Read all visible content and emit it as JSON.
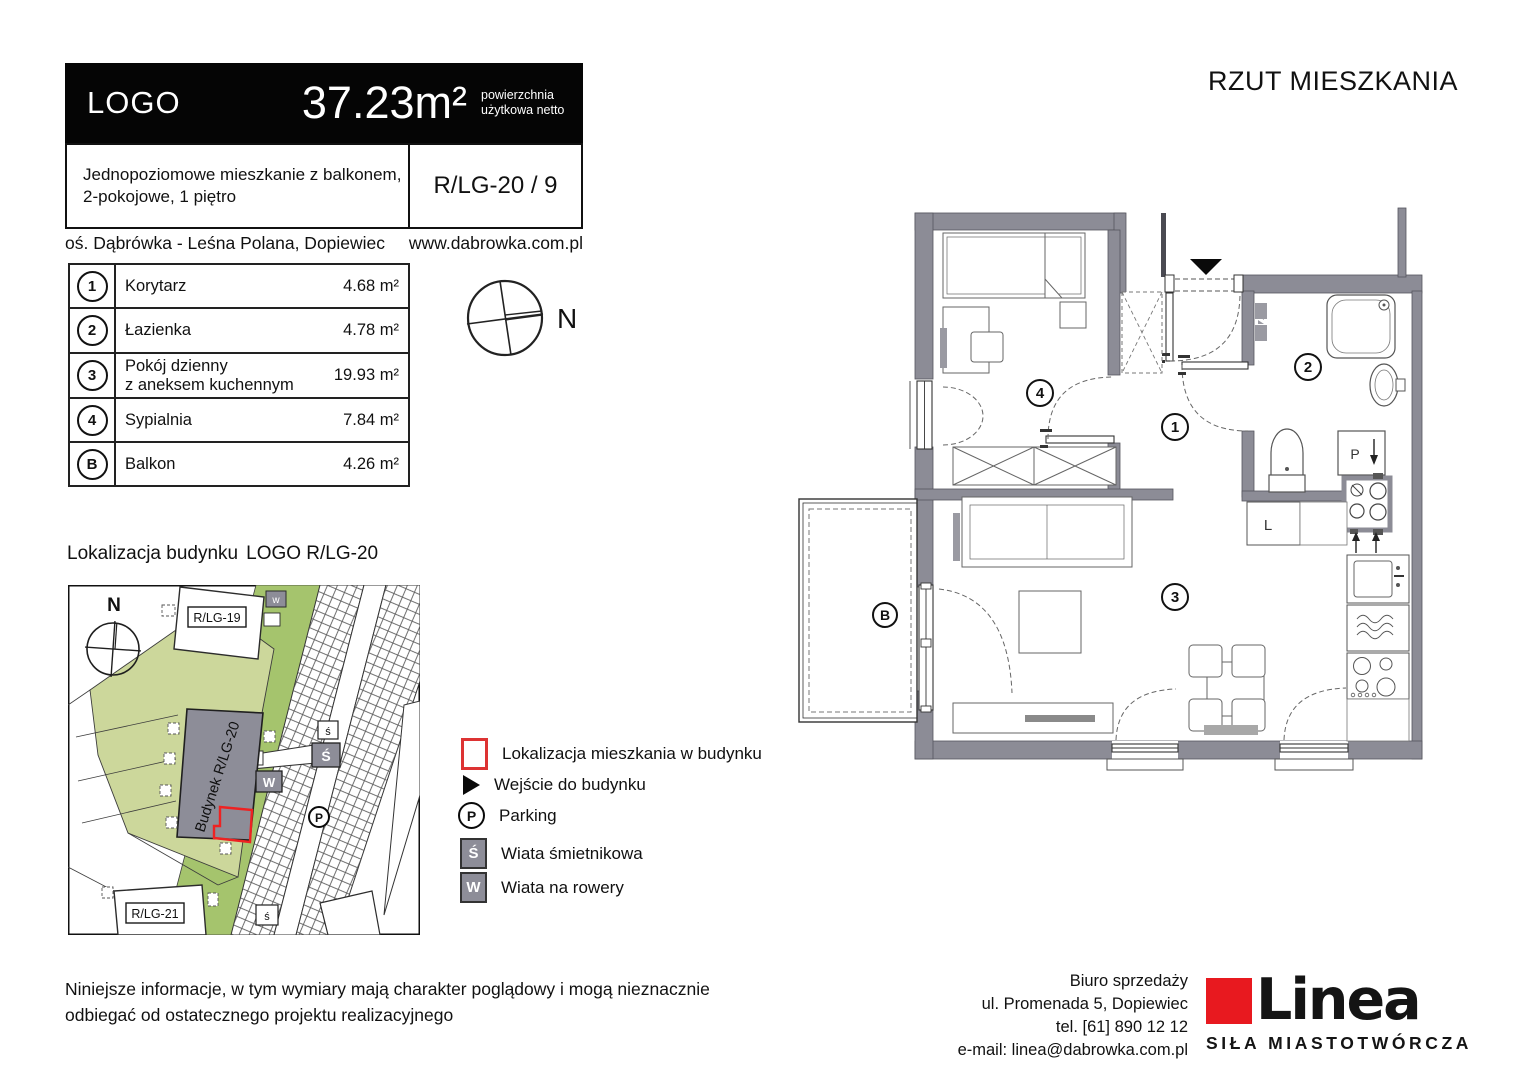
{
  "title": "RZUT MIESZKANIA",
  "header": {
    "logo": "LOGO",
    "area": "37.23m²",
    "area_note": "powierzchnia użytkowa netto",
    "description_line1": "Jednopoziomowe mieszkanie z balkonem,",
    "description_line2": "2-pokojowe, 1 piętro",
    "unit_code": "R/LG-20 / 9",
    "estate": "oś. Dąbrówka - Leśna Polana, Dopiewiec",
    "website": "www.dabrowka.com.pl"
  },
  "rooms": [
    {
      "id": "1",
      "label": "Korytarz",
      "label2": "",
      "area": "4.68 m²"
    },
    {
      "id": "2",
      "label": "Łazienka",
      "label2": "",
      "area": "4.78 m²"
    },
    {
      "id": "3",
      "label": "Pokój dzienny",
      "label2": "z aneksem kuchennym",
      "area": "19.93 m²"
    },
    {
      "id": "4",
      "label": "Sypialnia",
      "label2": "",
      "area": "7.84 m²"
    },
    {
      "id": "B",
      "label": "Balkon",
      "label2": "",
      "area": "4.26 m²"
    }
  ],
  "compass": {
    "label": "N"
  },
  "location": {
    "heading": "Lokalizacja budynku",
    "heading_code": "LOGO R/LG-20",
    "map": {
      "building_label": "Budynek R/LG-20",
      "building_19": "R/LG-19",
      "building_21": "R/LG-21",
      "north": "N",
      "parking": "P",
      "bike_shed": "W",
      "bin_shed": "Ś",
      "bin_small": "ś",
      "bin_small2": "ś",
      "bike_small": "w"
    }
  },
  "legend": [
    {
      "glyph": "",
      "label": "Lokalizacja mieszkania w budynku"
    },
    {
      "glyph": "",
      "label": "Wejście do budynku"
    },
    {
      "glyph": "P",
      "label": "Parking"
    },
    {
      "glyph": "Ś",
      "label": "Wiata śmietnikowa"
    },
    {
      "glyph": "W",
      "label": "Wiata na rowery"
    }
  ],
  "plan": {
    "labels": {
      "corridor": "1",
      "bathroom": "2",
      "living": "3",
      "bedroom": "4",
      "balcony": "B",
      "fridge": "L",
      "washer": "P"
    }
  },
  "footer": {
    "disclaimer_line1": "Niniejsze informacje, w tym wymiary mają charakter poglądowy i mogą nieznacznie",
    "disclaimer_line2": "odbiegać od ostatecznego projektu realizacyjnego",
    "office_line1": "Biuro sprzedaży",
    "office_line2": "ul. Promenada 5, Dopiewiec",
    "office_line3": "tel. [61] 890 12 12",
    "office_line4": "e-mail: linea@dabrowka.com.pl",
    "brand": {
      "name": "Linea",
      "tagline": "SIŁA MIASTOTWÓRCZA"
    }
  },
  "colors": {
    "wall": "#8c8c96",
    "site_green_light": "#ccd79b",
    "site_green": "#a5c46d",
    "apartment_red": "#e8232a",
    "brand_red": "#e8191f"
  }
}
